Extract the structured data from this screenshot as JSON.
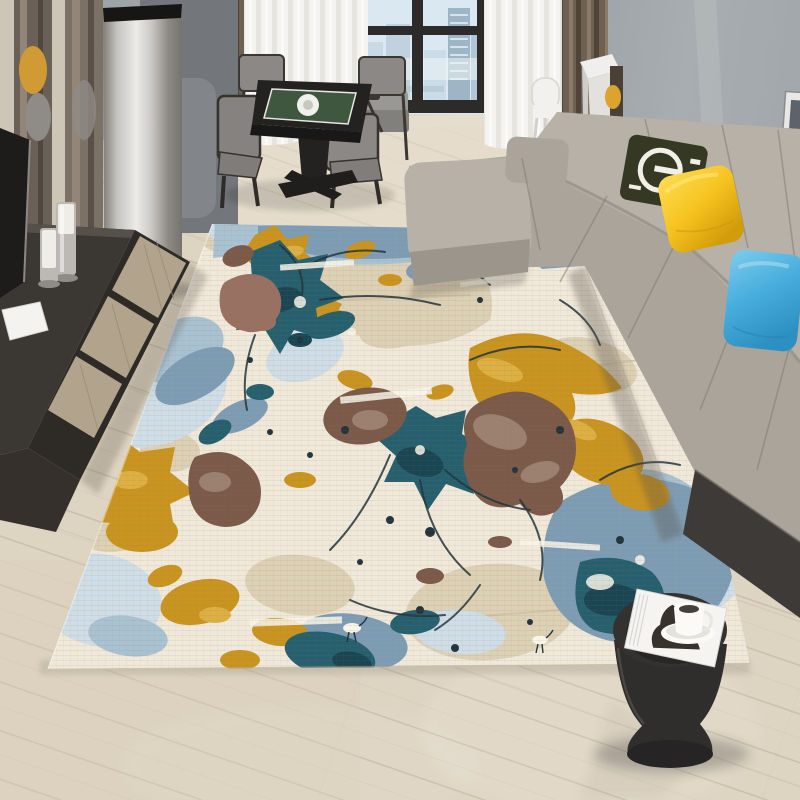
{
  "scene": {
    "kind": "interior product photograph",
    "subject": "abstract splatter-pattern area rug in a modern living room",
    "objects": {
      "rug": "abstract splatter rug (cream, steel blue, teal, mustard, brown)",
      "sofa": "gray L-shaped sectional sofa with olive logo pillow, yellow pillow, blue pillow",
      "dining_set": "black square game table with green felt top and four gray chairs",
      "window": "black-framed window with city skyline view",
      "curtains": "white sheer and brown drape panels",
      "media_console": "dark media console with light wood drawers, white book, candles",
      "air_conditioner": "stainless steel cylindrical floor unit",
      "side_table": "black hourglass stool with magazine and white coffee cup",
      "floor": "light wood plank flooring"
    }
  },
  "palette": {
    "wall_main": "#a8adb1",
    "wall_left": "#9aa0a5",
    "wall_corner_light": "#b6babd",
    "floor_base": "#ded4c2",
    "floor_light": "#ebe4d6",
    "floor_line": "#c0b299",
    "floor_warm": "#d9cdbb",
    "baseboard": "#e4ddcd",
    "window_frame": "#2c2b29",
    "sky": "#d9e8f1",
    "building_light": "#c8dae6",
    "building_mid": "#b0c6d4",
    "building_dark": "#9db6c6",
    "haze": "#f0f5f8",
    "sheer": "#f4f3f0",
    "sheer_shadow": "#dcd9d3",
    "curtain_brown": "#6e6052",
    "curtain_brown_dark": "#4f4437",
    "curtain_brown_light": "#8a7a66",
    "panel_gray": "#73767a",
    "panel_gray_light": "#82858a",
    "steel_mid": "#c6c4c0",
    "steel_light": "#edebe7",
    "steel_dark": "#76736e",
    "steel_cap": "#161615",
    "mirror_wood_dark": "#6b6057",
    "mirror_wood_light": "#9c8f80",
    "trim_wood": "#cdc5b5",
    "reflection_yellow": "#d09a34",
    "reflection_gray": "#8f8b86",
    "tv_black": "#1d1c1b",
    "console_top": "#3b3733",
    "console_front": "#2e2a26",
    "console_wood": "#b2a38c",
    "console_wood_line": "#97876e",
    "book_white": "#f4f3ef",
    "candle_metal": "#bcb9b4",
    "candle_wax": "#efede7",
    "chair_fabric": "#8b8885",
    "chair_frame": "#3b3733",
    "table_black": "#242220",
    "table_green": "#40573f",
    "table_line": "#e9e8e2",
    "plate_white": "#f1f0ec",
    "armchair_gray": "#8f8d8a",
    "desk_white": "#f0efed",
    "desk_chair_yellow": "#dca42e",
    "desk_chair_brown": "#4a4038",
    "chair_white": "#f2f1ee",
    "frame_white": "#e9e8e5",
    "frame_image": "#5c636b",
    "sofa_light": "#aaa49b",
    "sofa_mid": "#9b958c",
    "sofa_highlight": "#b8b1a8",
    "sofa_shade": "#8c857d",
    "sofa_base_dark": "#3e3a38",
    "pillow_olive": "#353822",
    "pillow_logo": "#f2efe7",
    "pillow_yellow": "#f5c31e",
    "pillow_yellow_light": "#ffdd55",
    "pillow_yellow_dark": "#d29d0b",
    "pillow_blue": "#48aedd",
    "pillow_blue_light": "#7ecdec",
    "pillow_blue_dark": "#2d90c2",
    "stool_black": "#302e2d",
    "stool_light": "#4e4b47",
    "magazine_white": "#f5f4f1",
    "magazine_art": "#38322c",
    "cup_white": "#fbfaf7",
    "coffee_dark": "#46403b",
    "rug_base": "#f0e9da",
    "rug_cream": "#f9f5e9",
    "rug_tan": "#dcd0b5",
    "rug_tan_dark": "#c9bb9c",
    "rug_blue": "#7e9db4",
    "rug_blue_light": "#a9c2d2",
    "rug_blue_pale": "#cfdde6",
    "rug_teal": "#26606e",
    "rug_teal_dark": "#1a4552",
    "rug_gold": "#c9941f",
    "rug_gold_light": "#ddb043",
    "rug_brown": "#7b5a49",
    "rug_brown_light": "#9d8170",
    "rug_mauve": "#997162",
    "rug_drip": "#22343c"
  }
}
